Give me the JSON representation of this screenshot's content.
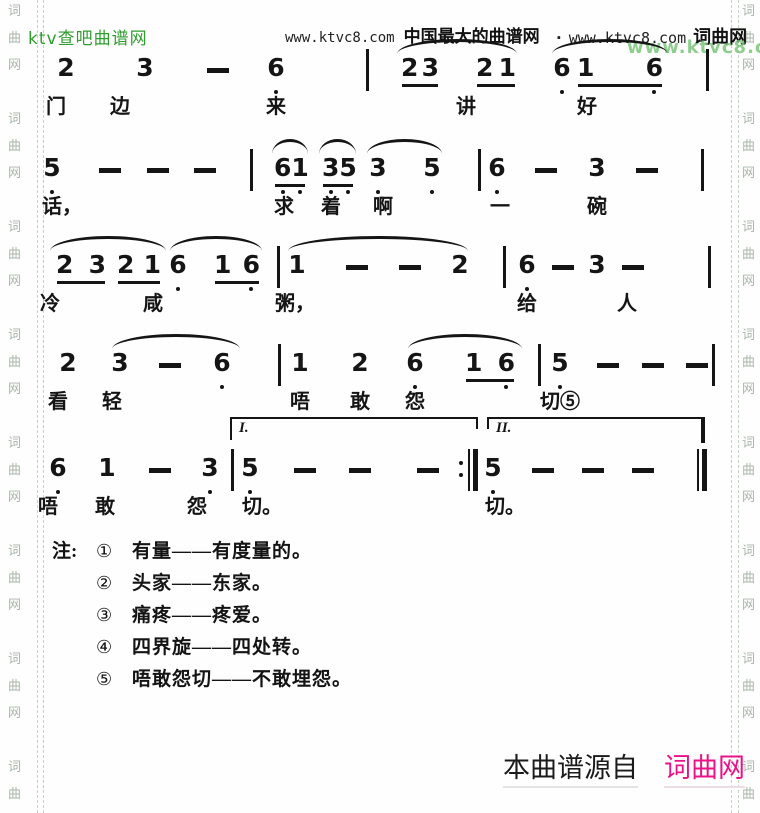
{
  "page": {
    "bg": "#ffffff",
    "ink": "#151515",
    "green": "#2f9e2f",
    "green_soft": "#7dc67d",
    "pink": "#e81389",
    "watermark_color": "#a9b6a9"
  },
  "header": {
    "site_name": "ktv查吧曲谱网",
    "center_url": "www.ktvc8.com",
    "center_title": "中国最大的曲谱网",
    "right_prefix": "·",
    "right_url": "www.ktvc8.com",
    "right_site": "词曲网",
    "watermark_url": "www.ktvc8.com"
  },
  "side_watermark": {
    "chars": [
      "词",
      "曲",
      "网"
    ],
    "groups": 8
  },
  "score": {
    "systems": [
      {
        "top": 55,
        "slurs": [
          {
            "x1": 397,
            "x2": 517
          },
          {
            "x1": 552,
            "x2": 668
          }
        ],
        "notes": [
          {
            "t": "2",
            "x": 66
          },
          {
            "t": "3",
            "x": 145
          },
          {
            "t": "-",
            "x": 218
          },
          {
            "t": "6",
            "x": 276,
            "dots": "1"
          },
          {
            "bar": "single",
            "x": 366
          },
          {
            "t": "23",
            "x": 420,
            "w": 38,
            "u": 1
          },
          {
            "t": "21",
            "x": 496,
            "w": 40,
            "u": 1
          },
          {
            "t": "6",
            "x": 562,
            "dots": "1"
          },
          {
            "t": "16",
            "x": 620,
            "w": 86,
            "u": 1,
            "dots": "01"
          },
          {
            "bar": "single",
            "x": 706
          }
        ],
        "lyrics": [
          {
            "t": "门",
            "x": 56
          },
          {
            "t": "边",
            "x": 120
          },
          {
            "t": "来",
            "x": 276
          },
          {
            "t": "讲",
            "x": 466
          },
          {
            "t": "好",
            "x": 587
          }
        ]
      },
      {
        "top": 155,
        "slurs": [
          {
            "x1": 272,
            "x2": 308
          },
          {
            "x1": 319,
            "x2": 356
          },
          {
            "x1": 367,
            "x2": 442
          }
        ],
        "notes": [
          {
            "t": "5",
            "x": 52,
            "dots": "1"
          },
          {
            "t": "-",
            "x": 110
          },
          {
            "t": "-",
            "x": 158
          },
          {
            "t": "-",
            "x": 205
          },
          {
            "bar": "single",
            "x": 250
          },
          {
            "t": "61",
            "x": 290,
            "w": 32,
            "u": 1,
            "dots": "11"
          },
          {
            "t": "35",
            "x": 338,
            "w": 32,
            "u": 1,
            "dots": "11"
          },
          {
            "t": "3",
            "x": 378,
            "dots": "1"
          },
          {
            "t": "5",
            "x": 432,
            "dots": "1"
          },
          {
            "bar": "single",
            "x": 478
          },
          {
            "t": "6",
            "x": 497,
            "dots": "1"
          },
          {
            "t": "-",
            "x": 546
          },
          {
            "t": "3",
            "x": 597
          },
          {
            "t": "-",
            "x": 647
          },
          {
            "bar": "single",
            "x": 701
          }
        ],
        "lyrics": [
          {
            "t": "话，",
            "x": 62
          },
          {
            "t": "求",
            "x": 284
          },
          {
            "t": "着",
            "x": 331
          },
          {
            "t": "啊",
            "x": 383
          },
          {
            "t": "一",
            "x": 500
          },
          {
            "t": "碗",
            "x": 597
          }
        ]
      },
      {
        "top": 252,
        "slurs": [
          {
            "x1": 50,
            "x2": 166
          },
          {
            "x1": 170,
            "x2": 262
          },
          {
            "x1": 288,
            "x2": 468
          }
        ],
        "notes": [
          {
            "t": "23",
            "x": 81,
            "w": 50,
            "u": 1
          },
          {
            "t": "21",
            "x": 139,
            "w": 44,
            "u": 1
          },
          {
            "t": "6",
            "x": 178,
            "dots": "1"
          },
          {
            "t": "16",
            "x": 237,
            "w": 46,
            "u": 1,
            "dots": "01"
          },
          {
            "bar": "single",
            "x": 277
          },
          {
            "t": "1",
            "x": 297
          },
          {
            "t": "-",
            "x": 357
          },
          {
            "t": "-",
            "x": 410
          },
          {
            "t": "2",
            "x": 460
          },
          {
            "bar": "single",
            "x": 503
          },
          {
            "t": "6",
            "x": 527,
            "dots": "1"
          },
          {
            "t": "-",
            "x": 563
          },
          {
            "t": "3",
            "x": 597
          },
          {
            "t": "-",
            "x": 633
          },
          {
            "bar": "single",
            "x": 708
          }
        ],
        "lyrics": [
          {
            "t": "冷",
            "x": 50
          },
          {
            "t": "咸",
            "x": 153
          },
          {
            "t": "粥，",
            "x": 295
          },
          {
            "t": "给",
            "x": 527
          },
          {
            "t": "人",
            "x": 627
          }
        ]
      },
      {
        "top": 350,
        "slurs": [
          {
            "x1": 112,
            "x2": 240
          },
          {
            "x1": 408,
            "x2": 522
          }
        ],
        "notes": [
          {
            "t": "2",
            "x": 68
          },
          {
            "t": "3",
            "x": 120
          },
          {
            "t": "-",
            "x": 170
          },
          {
            "t": "6",
            "x": 222,
            "dots": "1"
          },
          {
            "bar": "single",
            "x": 278
          },
          {
            "t": "1",
            "x": 300
          },
          {
            "t": "2",
            "x": 360
          },
          {
            "t": "6",
            "x": 415,
            "dots": "1"
          },
          {
            "t": "16",
            "x": 490,
            "w": 50,
            "u": 1,
            "dots": "01"
          },
          {
            "bar": "single",
            "x": 538
          },
          {
            "t": "5",
            "x": 560,
            "dots": "1"
          },
          {
            "t": "-",
            "x": 608
          },
          {
            "t": "-",
            "x": 653
          },
          {
            "t": "-",
            "x": 697
          },
          {
            "bar": "single",
            "x": 712
          }
        ],
        "lyrics": [
          {
            "t": "看",
            "x": 58
          },
          {
            "t": "轻",
            "x": 112
          },
          {
            "t": "唔",
            "x": 300
          },
          {
            "t": "敢",
            "x": 360
          },
          {
            "t": "怨",
            "x": 415
          },
          {
            "t": "切⑤",
            "x": 560
          }
        ]
      },
      {
        "top": 455,
        "slurs": [],
        "volta": [
          {
            "label": "I.",
            "x1": 230,
            "x2": 478
          },
          {
            "label": "II.",
            "x1": 487,
            "x2": 705,
            "hook": 1
          }
        ],
        "notes": [
          {
            "t": "6",
            "x": 58,
            "dots": "1"
          },
          {
            "t": "1",
            "x": 107
          },
          {
            "t": "-",
            "x": 160
          },
          {
            "t": "3",
            "x": 210,
            "dots": "1"
          },
          {
            "bar": "single",
            "x": 231
          },
          {
            "t": "5",
            "x": 250,
            "dots": "1"
          },
          {
            "t": "-",
            "x": 305
          },
          {
            "t": "-",
            "x": 360
          },
          {
            "t": "-",
            "x": 428
          },
          {
            "bar": "repeat-end",
            "x": 466
          },
          {
            "t": "5",
            "x": 493,
            "dots": "1"
          },
          {
            "t": "-",
            "x": 543
          },
          {
            "t": "-",
            "x": 593
          },
          {
            "t": "-",
            "x": 643
          },
          {
            "bar": "final",
            "x": 695
          }
        ],
        "lyrics": [
          {
            "t": "唔",
            "x": 48
          },
          {
            "t": "敢",
            "x": 105
          },
          {
            "t": "怨",
            "x": 197
          },
          {
            "t": "切。",
            "x": 262
          },
          {
            "t": "切。",
            "x": 505
          }
        ]
      }
    ]
  },
  "footnotes": {
    "label": "注:",
    "items": [
      {
        "num": "①",
        "text": "有量——有度量的。"
      },
      {
        "num": "②",
        "text": "头家——东家。"
      },
      {
        "num": "③",
        "text": "痛疼——疼爱。"
      },
      {
        "num": "④",
        "text": "四界旋——四处转。"
      },
      {
        "num": "⑤",
        "text": "唔敢怨切——不敢埋怨。"
      }
    ]
  },
  "footer": {
    "source_text": "本曲谱源自",
    "source_site": "词曲网"
  }
}
